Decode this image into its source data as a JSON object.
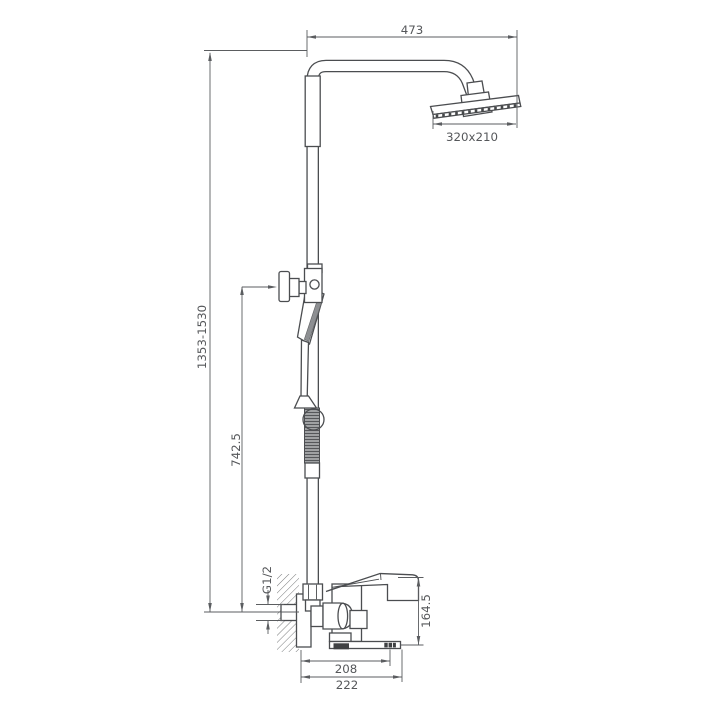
{
  "diagram": {
    "type": "technical-drawing",
    "subject": "Shower column with overhead rain shower, hand shower and wall-mounted bath mixer - dimensioned side view",
    "background": "#ffffff",
    "line_color": "#4b4d50",
    "dimension_line_color": "#5b5d60",
    "text_color": "#55575a",
    "labels": {
      "arm_reach": "473",
      "head_size": "320x210",
      "overall_height": "1353-1530",
      "hand_shower_height": "742.5",
      "inlet_thread": "G1/2",
      "mixer_height": "164.5",
      "spout_reach_aerator": "208",
      "spout_reach_total": "222"
    }
  }
}
